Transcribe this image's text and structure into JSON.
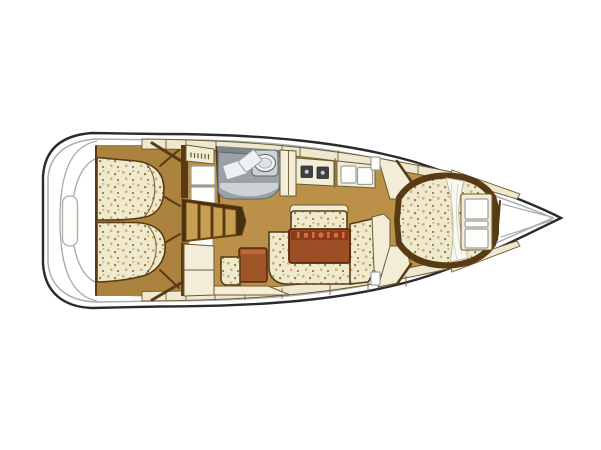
{
  "image": {
    "width": 601,
    "height": 450,
    "background": "#ffffff"
  },
  "diagram": {
    "type": "yacht-interior-floor-plan",
    "orientation": "bow-right-stern-left",
    "palette": {
      "background": "#ffffff",
      "hull_fill": "#ffffff",
      "hull_outline": "#2b2b2b",
      "deck_line": "#a9aeb2",
      "deck_cream": "#efe7cf",
      "cabinet_cream": "#f3ecd6",
      "wood_floor": "#bb9149",
      "wood_aft": "#ab823e",
      "trim_dark": "#583b14",
      "trim_mid": "#6b5b33",
      "steps_back": "#46300f",
      "steps_fill": "#c89e52",
      "steps_stroke": "#6b4516",
      "cushion_fill": "#efe9d0",
      "cushion_dot_light": "#c9b062",
      "cushion_dot_dark": "#9c7d39",
      "table_top": "#9c4f27",
      "table_shade": "#8a3c18",
      "table_accent": "#d4703c",
      "table_edge": "#55280e",
      "stool_brown": "#a05527",
      "stool_edge": "#b96a38",
      "counter_back": "#7d868b",
      "counter_body": "#9aa2a7",
      "counter_front": "#cdd3d4",
      "counter_white": "#eef1f1",
      "counter_inner": "#dfe5e5",
      "counter_edge": "#5f676b",
      "appliance_dark": "#3f4244",
      "locker_white": "#fdfdf9",
      "locker_stroke": "#9aa0a4",
      "sheet_white": "#fbfaf2",
      "sheet_edge": "#bdb8a6",
      "sheet_fold": "#d8d3c2"
    },
    "regions": [
      {
        "id": "stern-swim-platform",
        "label": "Stern swim platform"
      },
      {
        "id": "aft-berth-port",
        "label": "Aft double berth (top)"
      },
      {
        "id": "aft-berth-starboard",
        "label": "Aft double berth (bottom)"
      },
      {
        "id": "aft-lockers",
        "label": "Aft lockers and louvered doors"
      },
      {
        "id": "companionway-steps",
        "label": "Companionway steps"
      },
      {
        "id": "galley-sink-counter",
        "label": "Galley counter with sink"
      },
      {
        "id": "galley-stove",
        "label": "Stove with two burners"
      },
      {
        "id": "galley-icebox",
        "label": "Icebox with twin lids"
      },
      {
        "id": "saloon-bench",
        "label": "Saloon forward bench"
      },
      {
        "id": "saloon-table",
        "label": "Saloon table with bottle rack"
      },
      {
        "id": "saloon-settee",
        "label": "L-shaped settee"
      },
      {
        "id": "nav-stool",
        "label": "Navigator stool"
      },
      {
        "id": "forward-v-berth",
        "label": "Forward V-berth"
      },
      {
        "id": "forward-drawers",
        "label": "Forward cabin drawers"
      },
      {
        "id": "bow-anchor-locker",
        "label": "Bow anchor locker"
      }
    ]
  }
}
